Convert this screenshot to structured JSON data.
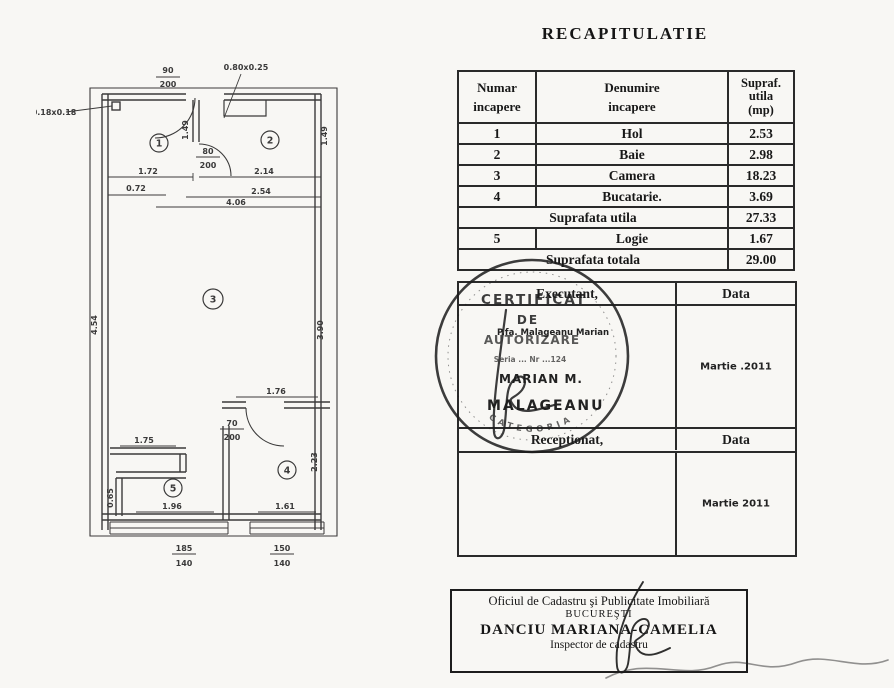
{
  "title": "RECAPITULATIE",
  "recap_table": {
    "headers": {
      "col1": "Numar\nincapere",
      "col2": "Denumire\nincapere",
      "col3": "Supraf.\nutila\n(mp)"
    },
    "rows": [
      {
        "nr": "1",
        "name": "Hol",
        "area": "2.53"
      },
      {
        "nr": "2",
        "name": "Baie",
        "area": "2.98"
      },
      {
        "nr": "3",
        "name": "Camera",
        "area": "18.23"
      },
      {
        "nr": "4",
        "name": "Bucatarie.",
        "area": "3.69"
      },
      {
        "label": "Suprafata utila",
        "area": "27.33"
      },
      {
        "nr": "5",
        "name": "Logie",
        "area": "1.67"
      },
      {
        "label": "Suprafata totala",
        "area": "29.00"
      }
    ]
  },
  "executant": {
    "header": "Executant,",
    "data_header": "Data",
    "name_line": "P.fa.  Malageanu  Marian",
    "sig_line1": "MARIAN M.",
    "sig_line2": "MALAGEANU",
    "date": "Martie .2011",
    "receptionat_header": "Receptionat,",
    "data_header2": "Data",
    "date2": "Martie  2011"
  },
  "stamp": {
    "line1": "CERTIFICAT",
    "line2": "DE",
    "line3": "AUTORIZARE",
    "serial": "Seria ...  Nr ...124",
    "ring_word": "CATEGORIA"
  },
  "footer_box": {
    "line1": "Oficiul de Cadastru şi Publicitate Imobiliară",
    "line2": "BUCUREŞTI",
    "line3": "DANCIU MARIANA-CAMELIA",
    "line4": "Inspector de cadastru"
  },
  "plan": {
    "room_labels": {
      "r1": "1",
      "r2": "2",
      "r3": "3",
      "r4": "4",
      "r5": "5"
    },
    "dims": {
      "pillar": "0.18x0.18",
      "beam": "0.80x0.25",
      "door_top_n": "90",
      "door_top_d": "200",
      "door_mid_n": "80",
      "door_mid_d": "200",
      "door_low_n": "70",
      "door_low_d": "200",
      "w172": "1.72",
      "w214": "2.14",
      "h149a": "1.49",
      "h149b": "1.49",
      "w072": "0.72",
      "w254": "2.54",
      "w406": "4.06",
      "h454": "4.54",
      "h390": "3.90",
      "w176": "1.76",
      "w175": "1.75",
      "h223": "2.23",
      "h065": "0.65",
      "w196": "1.96",
      "w161": "1.61",
      "win1_n": "185",
      "win1_d": "140",
      "win2_n": "150",
      "win2_d": "140"
    }
  }
}
